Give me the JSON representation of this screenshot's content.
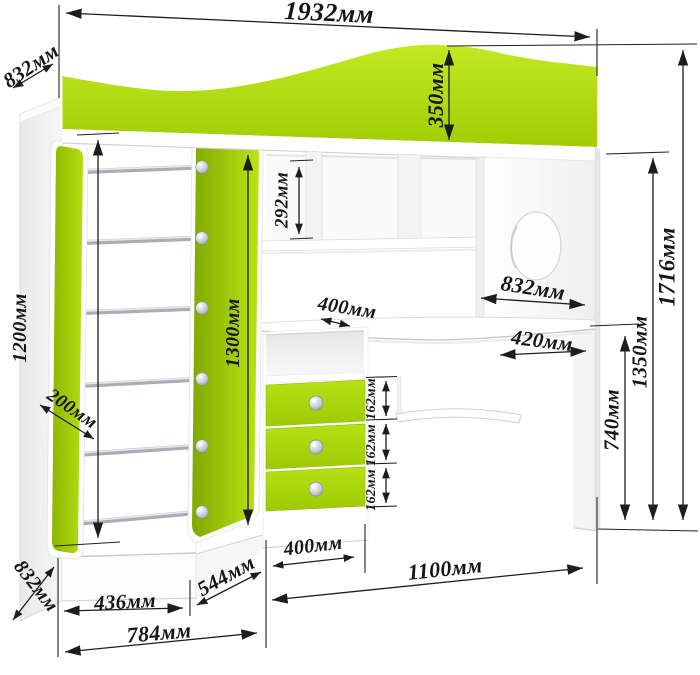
{
  "diagram": {
    "subject": "loft bed with wardrobe, ladder, drawer unit and corner desk — dimensioned drawing",
    "units": "мм",
    "colors": {
      "accent_green": "#aadb10",
      "accent_green_dark": "#86ad04",
      "line_color": "#1d1d1d",
      "background": "#ffffff"
    },
    "dimensions": {
      "total_width": "1932мм",
      "depth_top": "832мм",
      "headboard_height": "350мм",
      "shelf_opening_height": "292мм",
      "wardrobe_interior_height": "1200мм",
      "ladder_stile_depth": "200мм",
      "bunk_panel_height": "1300мм",
      "shelf_depth": "400мм",
      "desk_width": "832мм",
      "desk_right_depth": "420мм",
      "total_height": "1716мм",
      "bed_base_height": "1350мм",
      "desk_height": "740мм",
      "drawer_front_1": "162мм",
      "drawer_front_2": "162мм",
      "drawer_front_3": "162мм",
      "depth_bottom": "832мм",
      "wardrobe_width": "436мм",
      "corner_section_width": "544мм",
      "base_width": "784мм",
      "drawer_unit_width": "400мм",
      "desk_section_width": "1100мм"
    }
  }
}
